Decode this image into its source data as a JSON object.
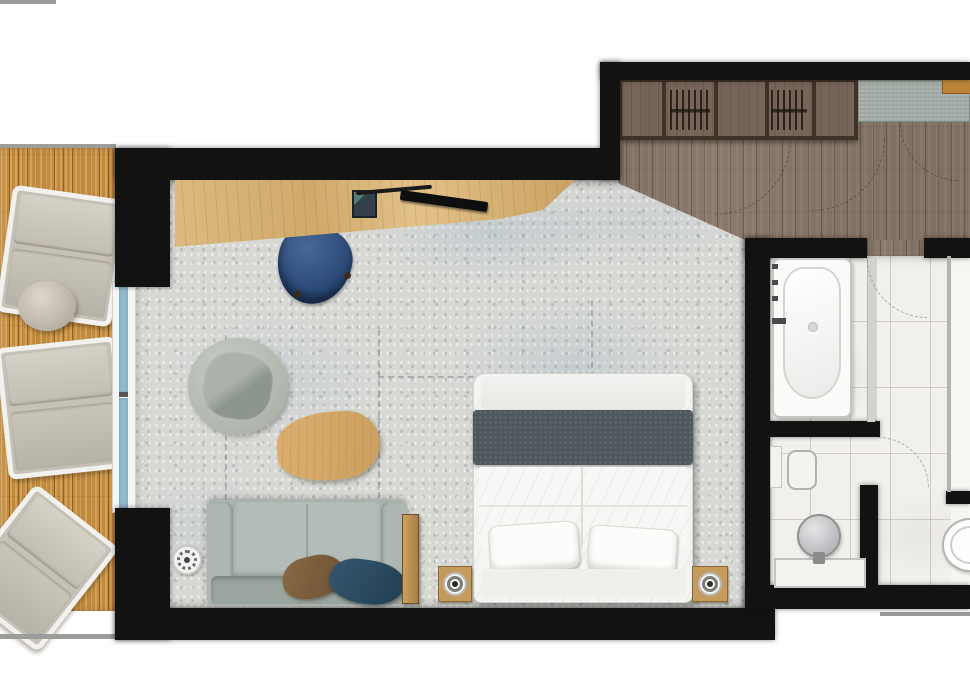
{
  "meta": {
    "title": "Hotel suite floor plan",
    "visible_text": []
  },
  "palette": {
    "wall": "#121212",
    "concrete_floor": "#d7d8d4",
    "balcony_wood": "#c28a3e",
    "entry_wood": "#8a796c",
    "bathroom_tile": "#f1f0ec",
    "window_glazing": "#8fb9cc",
    "desk_wood": "#d7b577",
    "desk_chair_navy": "#2c4a78",
    "sofa_grey": "#a9b2ad",
    "bed_runner": "#4f595d",
    "cushion_brown": "#7d5f3e",
    "cushion_navy": "#27455c",
    "coffee_table_wood": "#d3a868",
    "entry_mat": "#a7afaa",
    "wardrobe_frame": "#3f3226"
  },
  "rooms": [
    {
      "name": "Balcony",
      "floor": "wood decking"
    },
    {
      "name": "Living and sleeping room",
      "floor": "concrete"
    },
    {
      "name": "Entry hall",
      "floor": "dark wood planks"
    },
    {
      "name": "Bathroom",
      "floor": "white tile"
    }
  ],
  "labels": {
    "lounger": "Sun lounger",
    "side_table": "Round side table",
    "window": "Sliding glass door",
    "desk": "Desk",
    "desk_chair": "Desk chair",
    "tv": "TV",
    "laptop": "Laptop",
    "remote": "Remote",
    "armchair": "Swivel armchair",
    "coffee_table": "Coffee table",
    "sofa": "Sofa",
    "cushion_brown": "Brown cushion",
    "cushion_navy": "Navy cushion",
    "floor_lamp": "Floor lamp",
    "console": "Console shelf",
    "bed": "Double bed",
    "runner": "Bed runner",
    "pillow": "Pillow",
    "nightstand": "Nightstand with lamp",
    "wardrobe": "Built-in wardrobe",
    "entry_mat": "Entry mat",
    "entry_door": "Entrance door",
    "threshold": "Bathroom doorway",
    "door_swing": "Door swing",
    "bathtub": "Bathtub",
    "partition": "Shower partition",
    "vanity": "Vanity counter",
    "sink": "Washbasin",
    "toilet": "Toilet",
    "niche": "Wall niche",
    "stool": "Bath stool"
  }
}
